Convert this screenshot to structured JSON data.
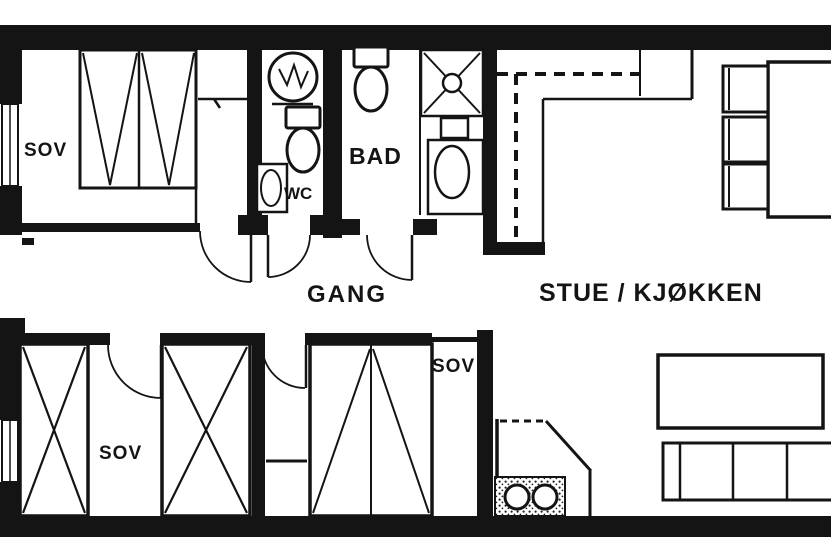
{
  "meta": {
    "document_type": "apartment floor plan (scanned drawing)",
    "language": "Norwegian",
    "ink_color": "#141414",
    "paper_color": "#ffffff"
  },
  "rooms": [
    {
      "id": "sov-top-left",
      "label": "SOV"
    },
    {
      "id": "wc",
      "label": "WC"
    },
    {
      "id": "bad",
      "label": "BAD"
    },
    {
      "id": "gang",
      "label": "GANG"
    },
    {
      "id": "stue-kjokken",
      "label": "STUE / KJØKKEN"
    },
    {
      "id": "sov-bottom-left",
      "label": "SOV"
    },
    {
      "id": "sov-bottom-middle",
      "label": "SOV"
    }
  ],
  "symbols": [
    "washing-machine",
    "toilet",
    "hand-basin",
    "shower-corner",
    "bathroom-sink",
    "wardrobe-cabinet",
    "double-bed",
    "kitchen-counter",
    "upper-cabinets-dashed",
    "cooktop-appliance",
    "dining-table",
    "chair",
    "sofa",
    "coffee-table",
    "corner-wood-stove",
    "door-swing",
    "window"
  ]
}
